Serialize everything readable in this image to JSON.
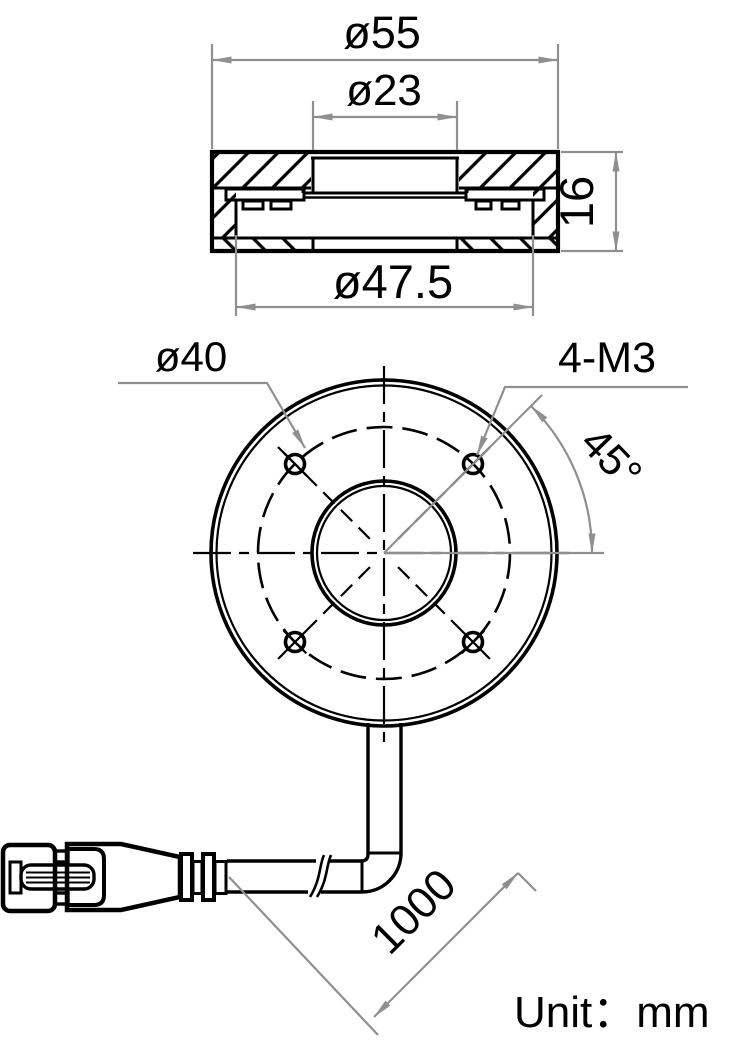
{
  "drawing_type": "ring-light mechanical dimension drawing",
  "labels": {
    "outer_diameter": "ø55",
    "window_diameter": "ø23",
    "height": "16",
    "body_diameter": "ø47.5",
    "bolt_circle_diameter": "ø40",
    "mounting_holes": "4-M3",
    "hole_angle": "45°",
    "cable_length": "1000",
    "unit": "Unit：mm"
  },
  "values": {
    "outer_diameter_mm": 55,
    "window_diameter_mm": 23,
    "height_mm": 16,
    "body_diameter_mm": 47.5,
    "bolt_circle_diameter_mm": 40,
    "mounting_hole_count": 4,
    "mounting_hole_thread": "M3",
    "hole_angle_deg": 45,
    "cable_length_mm": 1000
  },
  "colors": {
    "line": "#000000",
    "dimension": "#8f8f8f",
    "background": "#ffffff"
  }
}
